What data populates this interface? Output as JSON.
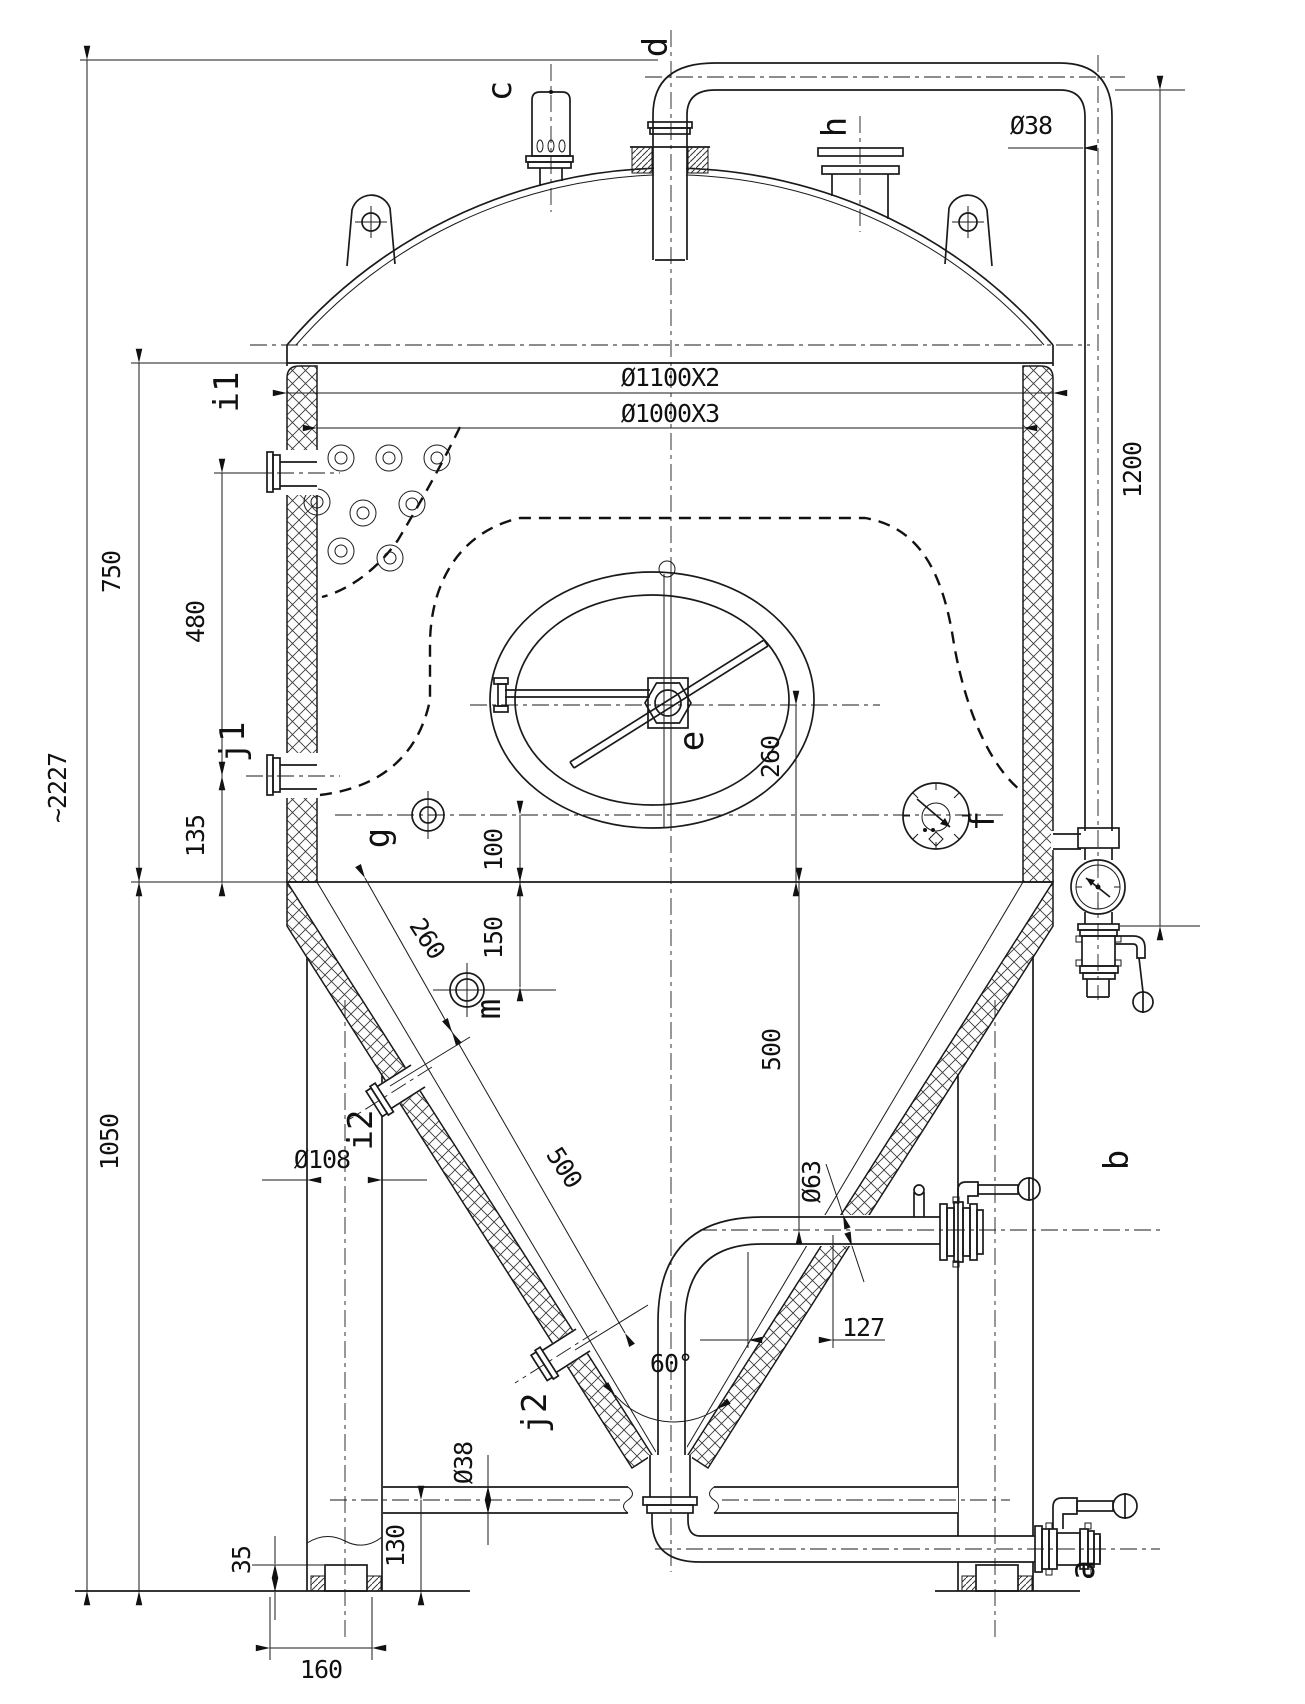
{
  "drawing": {
    "type": "technical-drawing",
    "subject": "conical fermenter tank general arrangement",
    "ports": {
      "a": "a",
      "b": "b",
      "c": "c",
      "d": "d",
      "e": "e",
      "f": "f",
      "g": "g",
      "h": "h",
      "i1": "i1",
      "i2": "i2",
      "j1": "j1",
      "j2": "j2",
      "m": "m"
    },
    "dims": {
      "overall_height": "~2227",
      "shell_height": "750",
      "side_port_spacing": "480",
      "j1_offset": "135",
      "lower_height": "1050",
      "foot_height": "35",
      "foot_width": "160",
      "bottom_pipe_elev": "130",
      "leg_diameter": "Ø108",
      "bottom_pipe_dia": "Ø38",
      "top_pipe_dia": "Ø38",
      "pipe_drop": "1200",
      "shell_od": "Ø1100X2",
      "shell_id": "Ø1000X3",
      "manway_offset": "260",
      "g_offset": "100",
      "cone_offset": "150",
      "cone_slope_upper": "260",
      "cone_slope_lower": "500",
      "outlet_height": "500",
      "outlet_dia": "Ø63",
      "outlet_offset": "127",
      "cone_angle": "60°"
    }
  }
}
